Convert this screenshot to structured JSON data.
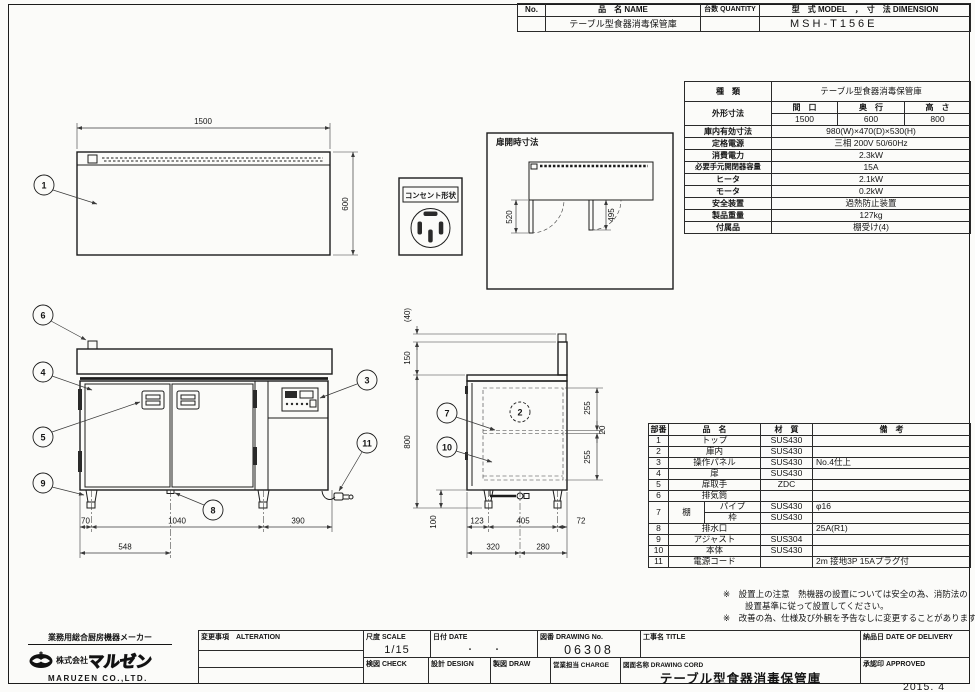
{
  "sheet": {
    "issue_date": "2015. 4"
  },
  "header_table": {
    "no_label": "No.",
    "name_label": "品　名 NAME",
    "qty_label": "台数 QUANTITY",
    "model_label": "型　式 MODEL　，　寸　法 DIMENSION",
    "no_value": "",
    "name_value": "テーブル型食器消毒保管庫",
    "qty_value": "",
    "model_value": "MSH-T156E"
  },
  "spec_table": {
    "kind_label": "種　類",
    "kind_value": "テーブル型食器消毒保管庫",
    "outer_label": "外形寸法",
    "outer_cols": [
      "間　口",
      "奥　行",
      "高　さ"
    ],
    "outer_values": [
      "1500",
      "600",
      "800"
    ],
    "rows": [
      {
        "label": "庫内有効寸法",
        "value": "980(W)×470(D)×530(H)"
      },
      {
        "label": "定格電源",
        "value": "三相 200V 50/60Hz"
      },
      {
        "label": "消費電力",
        "value": "2.3kW"
      },
      {
        "label": "必要手元開閉器容量",
        "value": "15A"
      },
      {
        "label": "ヒータ",
        "value": "2.1kW"
      },
      {
        "label": "モータ",
        "value": "0.2kW"
      },
      {
        "label": "安全装置",
        "value": "過熱防止装置"
      },
      {
        "label": "製品重量",
        "value": "127kg"
      },
      {
        "label": "付属品",
        "value": "棚受け(4)"
      }
    ]
  },
  "parts_table": {
    "headers": {
      "no": "部番",
      "name": "品　名",
      "material": "材　質",
      "note": "備　考"
    },
    "rows": [
      {
        "no": "1",
        "name": "トップ",
        "material": "SUS430",
        "note": ""
      },
      {
        "no": "2",
        "name": "庫内",
        "material": "SUS430",
        "note": ""
      },
      {
        "no": "3",
        "name": "操作パネル",
        "material": "SUS430",
        "note": "No.4仕上"
      },
      {
        "no": "4",
        "name": "扉",
        "material": "SUS430",
        "note": ""
      },
      {
        "no": "5",
        "name": "扉取手",
        "material": "ZDC",
        "note": ""
      },
      {
        "no": "6",
        "name": "排気筒",
        "material": "",
        "note": ""
      },
      {
        "no": "7",
        "name": "棚",
        "subs": [
          {
            "part": "パイプ",
            "material": "SUS430",
            "note": "φ16"
          },
          {
            "part": "枠",
            "material": "SUS430",
            "note": ""
          }
        ]
      },
      {
        "no": "8",
        "name": "排水口",
        "material": "",
        "note": "25A(R1)"
      },
      {
        "no": "9",
        "name": "アジャスト",
        "material": "SUS304",
        "note": ""
      },
      {
        "no": "10",
        "name": "本体",
        "material": "SUS430",
        "note": ""
      },
      {
        "no": "11",
        "name": "電源コード",
        "material": "",
        "note": "2m 接地3P 15Aプラグ付"
      }
    ]
  },
  "notes": {
    "line1": "※　設置上の注意　熱機器の設置については安全の為、消防法の",
    "line2": "設置基準に従って設置してください。",
    "line3": "※　改善の為、仕様及び外観を予告なしに変更することがあります。"
  },
  "company": {
    "tagline": "業務用総合厨房機器メーカー",
    "prefix": "株式会社",
    "brand": "マルゼン",
    "name_en": "MARUZEN CO.,LTD."
  },
  "titleblock": {
    "alteration_label": "変更事項　ALTERATION",
    "scale_label": "尺度 SCALE",
    "scale_value": "1/15",
    "date_label": "日付 DATE",
    "date_value": "・　　・",
    "drawing_no_label": "図番 DRAWING No.",
    "drawing_no_value": "06308",
    "title_label": "工事名 TITLE",
    "delivery_label": "納品日 DATE OF DELIVERY",
    "check_label": "検図 CHECK",
    "design_label": "設計 DESIGN",
    "draw_label": "製図 DRAW",
    "charge_label": "営業担当 CHARGE",
    "drawing_name_label": "図面名称 DRAWING CORD",
    "drawing_name_value": "テーブル型食器消毒保管庫",
    "approved_label": "承認印 APPROVED"
  },
  "drawing": {
    "top_view": {
      "c1": "1",
      "width": "1500",
      "depth": "600"
    },
    "outlet": {
      "label": "コンセント形状"
    },
    "door_open": {
      "label": "扉開時寸法",
      "left": "520",
      "right": "495"
    },
    "front": {
      "c3": "3",
      "c4": "4",
      "c5": "5",
      "c6": "6",
      "c8": "8",
      "c9": "9",
      "c11": "11",
      "d70": "70",
      "d1040": "1040",
      "d390": "390",
      "d548": "548"
    },
    "side": {
      "c2": "2",
      "c7": "7",
      "c10": "10",
      "d40": "(40)",
      "d150": "150",
      "d800": "800",
      "d100": "100",
      "d123": "123",
      "d405": "405",
      "d72": "72",
      "d320": "320",
      "d280": "280",
      "d255a": "255",
      "d20": "20",
      "d255b": "255"
    }
  }
}
